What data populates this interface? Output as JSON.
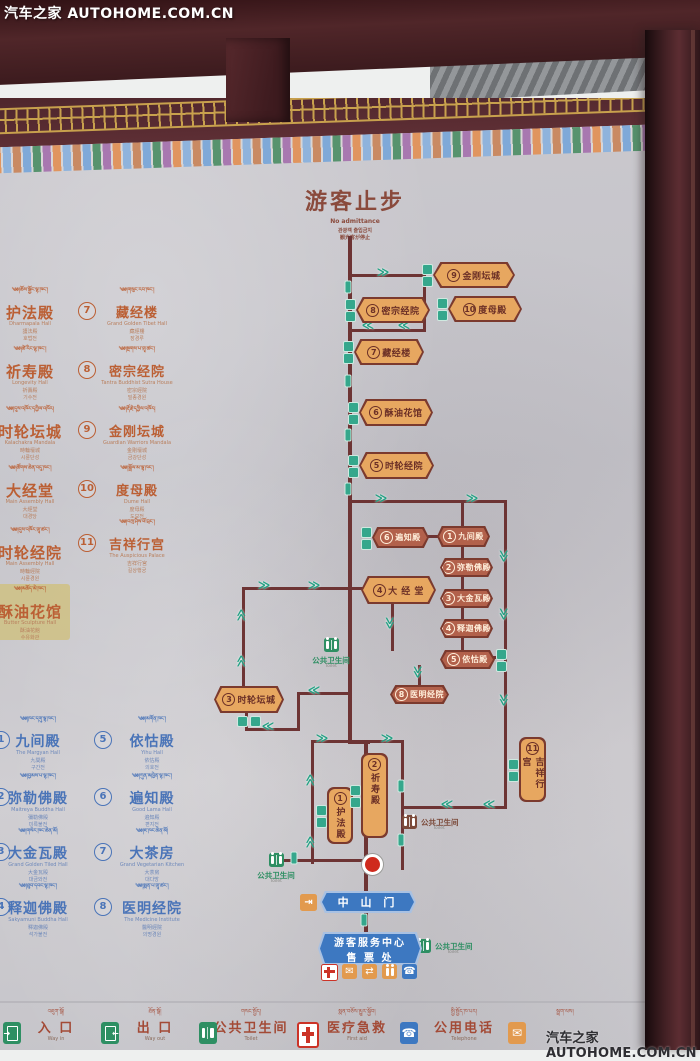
{
  "watermark": {
    "top_left": "汽车之家 AUTOHOME.COM.CN",
    "bottom_right": "汽车之家 AUTOHOME.COM.CN"
  },
  "title": {
    "zh": "游客止步",
    "en": "No admittance",
    "ko": "관광객 출입금지",
    "ja": "観光客が停止"
  },
  "legend_orange": {
    "left": [
      {
        "tibetan": "༄༅།ཆོས་སྐྱོང་ལྷ་ཁང་།",
        "zh": "护法殿",
        "en": "Dharmapala Hall",
        "sub1": "護法殿",
        "sub2": "호법전"
      },
      {
        "tibetan": "༄༅།ཚེ་རིང་ལྷ་ཁང་།",
        "zh": "祈寿殿",
        "en": "Longevity Hall",
        "sub1": "祈壽殿",
        "sub2": "기수전"
      },
      {
        "tibetan": "༄༅།དུས་འཁོར་དཀྱིལ་འཁོར།",
        "zh": "时轮坛城",
        "en": "Kalachakra Mandala",
        "sub1": "時輪壇城",
        "sub2": "시륜단성"
      },
      {
        "tibetan": "༄༅།ཚོགས་ཆེན་འདུ་ཁང་།",
        "zh": "大经堂",
        "en": "Main Assembly Hall",
        "sub1": "大經堂",
        "sub2": "대경당"
      },
      {
        "tibetan": "༄༅།དུས་འཁོར་གྲྭ་ཚང་།",
        "zh": "时轮经院",
        "en": "Main Assembly Hall",
        "sub1": "時輪經院",
        "sub2": "시륜경원"
      },
      {
        "tibetan": "༄༅།མཆོད་མེ་ཁང་།",
        "zh": "酥油花馆",
        "en": "Butter Sculpture Hall",
        "sub1": "酥油花館",
        "sub2": "수유화관",
        "highlight": true
      }
    ],
    "right": [
      {
        "num": "7",
        "tibetan": "༄༅།གསུང་རབ་ཁང་།",
        "zh": "藏经楼",
        "en": "Grand Golden Tibet Hall",
        "sub1": "藏經樓",
        "sub2": "장경루"
      },
      {
        "num": "8",
        "tibetan": "༄༅།སྔགས་པ་གྲྭ་ཚང་།",
        "zh": "密宗经院",
        "en": "Tantra Buddhist Sutra House",
        "sub1": "密宗經院",
        "sub2": "밀종경원"
      },
      {
        "num": "9",
        "tibetan": "༄༅།རྡོ་རྗེ་དཀྱིལ་འཁོར།",
        "zh": "金刚坛城",
        "en": "Guardian Warriors Mandala",
        "sub1": "金剛壇城",
        "sub2": "금강단성"
      },
      {
        "num": "10",
        "tibetan": "༄༅།སྒྲོལ་མ་ལྷ་ཁང་།",
        "zh": "度母殿",
        "en": "Dume Hall",
        "sub1": "度母殿",
        "sub2": "도모전"
      },
      {
        "num": "11",
        "tibetan": "༄༅།བཀྲ་ཤིས་ཕོ་བྲང་།",
        "zh": "吉祥行宫",
        "en": "The Auspicious Palace",
        "sub1": "吉祥行宮",
        "sub2": "길상행궁"
      }
    ]
  },
  "legend_blue": {
    "left": [
      {
        "num": "1",
        "tibetan": "༄༅།ཁང་དགུ་ལྷ་ཁང་།",
        "zh": "九间殿",
        "en": "The Margyan Hall",
        "sub1": "九間殿",
        "sub2": "구간전"
      },
      {
        "num": "2",
        "tibetan": "༄༅།བྱམས་པ་ལྷ་ཁང་།",
        "zh": "弥勒佛殿",
        "en": "Maitreya Buddha Hall",
        "sub1": "彌勒佛殿",
        "sub2": "미륵불전"
      },
      {
        "num": "3",
        "tibetan": "༄༅།གསེར་ཁང་ཆེན་མོ།",
        "zh": "大金瓦殿",
        "en": "Grand Golden Tiled Hall",
        "sub1": "大金瓦殿",
        "sub2": "대금와전"
      },
      {
        "num": "4",
        "tibetan": "༄༅།ཐུབ་དབང་ལྷ་ཁང་།",
        "zh": "释迦佛殿",
        "en": "Sakyamuni Buddha Hall",
        "sub1": "釋迦佛殿",
        "sub2": "석가불전"
      }
    ],
    "right": [
      {
        "num": "5",
        "tibetan": "༄༅།མགོན་ཁང་།",
        "zh": "依怙殿",
        "en": "Yihu Hall",
        "sub1": "依怙殿",
        "sub2": "의호전"
      },
      {
        "num": "6",
        "tibetan": "༄༅།ཀུན་མཁྱེན་ལྷ་ཁང་།",
        "zh": "遍知殿",
        "en": "Good Lama Hall",
        "sub1": "遍知殿",
        "sub2": "편지전"
      },
      {
        "num": "7",
        "tibetan": "༄༅།ཇ་ཁང་ཆེན་མོ།",
        "zh": "大茶房",
        "en": "Grand Vegetarian Kitchen",
        "sub1": "大茶房",
        "sub2": "대다방"
      },
      {
        "num": "8",
        "tibetan": "༄༅།སྨན་པ་གྲྭ་ཚང་།",
        "zh": "医明经院",
        "en": "The Medicine Institute",
        "sub1": "醫明經院",
        "sub2": "의명경원"
      }
    ]
  },
  "diagram": {
    "nodes": [
      {
        "shape": "h",
        "num": "9",
        "zh": "金刚坛城",
        "x": 433,
        "y": 262,
        "w": 82,
        "h": 26,
        "boxes": "left"
      },
      {
        "shape": "h",
        "num": "8",
        "zh": "密宗经院",
        "x": 356,
        "y": 297,
        "w": 74,
        "h": 26,
        "boxes": "left"
      },
      {
        "shape": "h",
        "num": "10",
        "zh": "度母殿",
        "x": 448,
        "y": 296,
        "w": 74,
        "h": 26,
        "boxes": "left"
      },
      {
        "shape": "h",
        "num": "7",
        "zh": "藏经楼",
        "x": 354,
        "y": 339,
        "w": 70,
        "h": 26,
        "boxes": "left"
      },
      {
        "shape": "h",
        "num": "6",
        "zh": "酥油花馆",
        "x": 359,
        "y": 399,
        "w": 74,
        "h": 27,
        "boxes": "left"
      },
      {
        "shape": "h",
        "num": "5",
        "zh": "时轮经院",
        "x": 359,
        "y": 452,
        "w": 75,
        "h": 27,
        "boxes": "left"
      },
      {
        "shape": "h",
        "num": "4",
        "zh": "大 经 堂",
        "x": 361,
        "y": 576,
        "w": 75,
        "h": 28,
        "boxes": "none"
      },
      {
        "shape": "h",
        "num": "3",
        "zh": "时轮坛城",
        "x": 214,
        "y": 686,
        "w": 70,
        "h": 27,
        "boxes": "bottom"
      },
      {
        "shape": "d",
        "num": "6",
        "zh": "遍知殿",
        "x": 372,
        "y": 527,
        "w": 57,
        "h": 21,
        "boxes": "left"
      },
      {
        "shape": "d",
        "num": "1",
        "zh": "九间殿",
        "x": 437,
        "y": 526,
        "w": 53,
        "h": 21,
        "boxes": "none"
      },
      {
        "shape": "d",
        "num": "2",
        "zh": "弥勒佛殿",
        "x": 440,
        "y": 558,
        "w": 53,
        "h": 19,
        "boxes": "none"
      },
      {
        "shape": "d",
        "num": "3",
        "zh": "大金瓦殿",
        "x": 440,
        "y": 589,
        "w": 53,
        "h": 19,
        "boxes": "none"
      },
      {
        "shape": "d",
        "num": "4",
        "zh": "释迦佛殿",
        "x": 440,
        "y": 619,
        "w": 53,
        "h": 19,
        "boxes": "none"
      },
      {
        "shape": "d",
        "num": "5",
        "zh": "依怙殿",
        "x": 440,
        "y": 650,
        "w": 55,
        "h": 19,
        "boxes": "right"
      },
      {
        "shape": "d",
        "num": "8",
        "zh": "医明经院",
        "x": 390,
        "y": 685,
        "w": 59,
        "h": 19,
        "boxes": "none"
      },
      {
        "shape": "v",
        "num": "1",
        "zh": "护法殿",
        "x": 327,
        "y": 787,
        "w": 26,
        "h": 57,
        "boxes": "left"
      },
      {
        "shape": "v",
        "num": "2",
        "zh": "祈寿殿",
        "x": 361,
        "y": 753,
        "w": 27,
        "h": 85,
        "boxes": "left"
      },
      {
        "shape": "v",
        "num": "11",
        "zh": "吉祥行宫",
        "x": 519,
        "y": 737,
        "w": 27,
        "h": 65,
        "boxes": "left"
      }
    ],
    "segments": [
      [
        348,
        236,
        4,
        507
      ],
      [
        348,
        740,
        22,
        4
      ],
      [
        364,
        740,
        4,
        196
      ],
      [
        350,
        274,
        76,
        3
      ],
      [
        423,
        274,
        3,
        58
      ],
      [
        350,
        329,
        76,
        3
      ],
      [
        350,
        500,
        157,
        3
      ],
      [
        504,
        500,
        3,
        309
      ],
      [
        404,
        806,
        103,
        3
      ],
      [
        401,
        740,
        3,
        130
      ],
      [
        311,
        740,
        93,
        3
      ],
      [
        311,
        740,
        3,
        124
      ],
      [
        282,
        859,
        86,
        3
      ],
      [
        461,
        500,
        3,
        27
      ],
      [
        461,
        546,
        3,
        13
      ],
      [
        461,
        576,
        3,
        14
      ],
      [
        461,
        607,
        3,
        13
      ],
      [
        461,
        637,
        3,
        14
      ],
      [
        493,
        656,
        13,
        3
      ],
      [
        418,
        665,
        3,
        21
      ],
      [
        428,
        535,
        11,
        3
      ],
      [
        242,
        587,
        121,
        3
      ],
      [
        242,
        587,
        3,
        102
      ],
      [
        245,
        711,
        3,
        20
      ],
      [
        245,
        728,
        55,
        3
      ],
      [
        297,
        692,
        3,
        39
      ],
      [
        297,
        692,
        53,
        3
      ],
      [
        391,
        603,
        3,
        48
      ]
    ],
    "markers": [
      [
        383,
        272,
        "r"
      ],
      [
        348,
        287,
        "c"
      ],
      [
        368,
        325,
        "l"
      ],
      [
        404,
        325,
        "l"
      ],
      [
        348,
        381,
        "c"
      ],
      [
        348,
        435,
        "c"
      ],
      [
        348,
        489,
        "c"
      ],
      [
        381,
        498,
        "r"
      ],
      [
        472,
        498,
        "r"
      ],
      [
        504,
        556,
        "d"
      ],
      [
        504,
        614,
        "d"
      ],
      [
        504,
        700,
        "d"
      ],
      [
        264,
        585,
        "r"
      ],
      [
        314,
        585,
        "r"
      ],
      [
        241,
        615,
        "u"
      ],
      [
        241,
        661,
        "u"
      ],
      [
        390,
        623,
        "d"
      ],
      [
        418,
        672,
        "d"
      ],
      [
        268,
        726,
        "l"
      ],
      [
        314,
        690,
        "l"
      ],
      [
        322,
        738,
        "r"
      ],
      [
        387,
        738,
        "r"
      ],
      [
        310,
        780,
        "u"
      ],
      [
        310,
        842,
        "u"
      ],
      [
        401,
        786,
        "c"
      ],
      [
        401,
        840,
        "c"
      ],
      [
        447,
        804,
        "l"
      ],
      [
        489,
        804,
        "l"
      ],
      [
        294,
        858,
        "c"
      ],
      [
        364,
        920,
        "c"
      ]
    ],
    "toilets": [
      {
        "style": "green",
        "layout": "stack",
        "zh": "公共卫生间",
        "en": "Toilet",
        "x": 331,
        "y": 638
      },
      {
        "style": "green",
        "layout": "stack",
        "zh": "公共卫生间",
        "en": "Toilet",
        "x": 276,
        "y": 853
      },
      {
        "style": "brown",
        "layout": "inline",
        "zh": "公共卫生间",
        "en": "Toilet",
        "x": 409,
        "y": 815
      },
      {
        "style": "green",
        "layout": "inline",
        "zh": "公共卫生间",
        "en": "Toilet",
        "x": 423,
        "y": 939
      }
    ],
    "gate": {
      "zh": "中 山 门"
    },
    "center": {
      "line1": "游客服务中心",
      "line2": "售 票 处"
    },
    "service_icons": [
      "first-aid-icon",
      "mail-icon",
      "exchange-icon",
      "visitors-icon",
      "phone-icon"
    ]
  },
  "footer": {
    "items": [
      {
        "tibetan": "འཇུག་སྒོ།",
        "zh": "入 口",
        "en": "Way in",
        "icon": "way-in"
      },
      {
        "tibetan": "ཐོན་སྒོ།",
        "zh": "出 口",
        "en": "Way out",
        "icon": "way-out"
      },
      {
        "tibetan": "གསང་སྤྱོད།",
        "zh": "公共卫生间",
        "en": "Toilet",
        "icon": "toilet"
      },
      {
        "tibetan": "སྨན་བཅོས་མྱུར་སྐྱོབ།",
        "zh": "医疗急救",
        "en": "First aid",
        "icon": "first-aid"
      },
      {
        "tibetan": "སྤྱི་སྤྱོད་ཁ་པར།",
        "zh": "公用电话",
        "en": "Telephone",
        "icon": "phone"
      },
      {
        "tibetan": "སྦྲག་ལས།",
        "zh": "",
        "en": "",
        "icon": "mail"
      }
    ]
  },
  "colors": {
    "board": "#c7c6cb",
    "frame": "#442125",
    "line": "#6d3434",
    "node_orange": "#e7a760",
    "node_dark": "#b2614b",
    "node_border": "#7b3a2e",
    "teal_marker": "#35a78c",
    "legend_orange": "#bb5f34",
    "legend_blue": "#4a74b8",
    "banner_blue": "#3d78c1",
    "toilet_green": "#2e8f63",
    "gold": "#c8a14d",
    "red_dot": "#cf2a1d"
  }
}
